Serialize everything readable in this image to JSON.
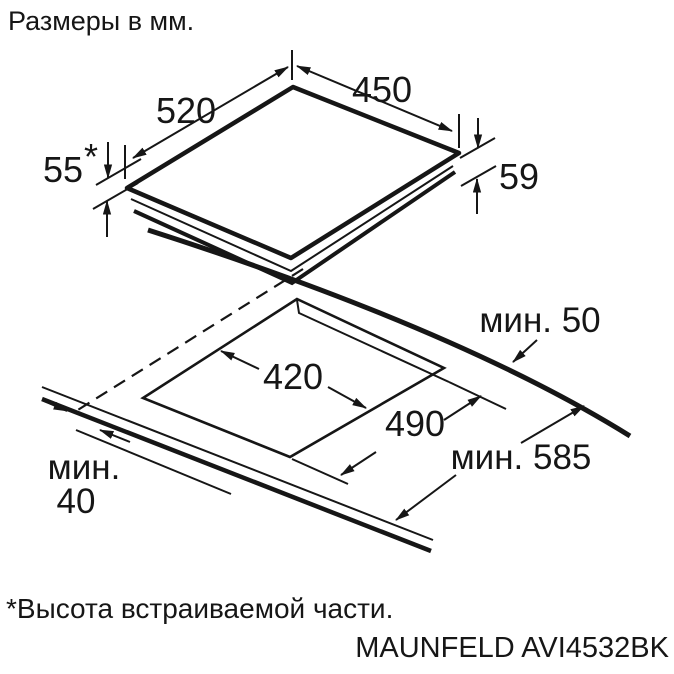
{
  "page": {
    "title": "Размеры в мм.",
    "footnote": "*Высота встраиваемой части.",
    "model": "MAUNFELD AVI4532BK"
  },
  "top_view": {
    "description": "hob perspective view",
    "depth_label": "520",
    "width_label": "450",
    "height_front_label": "55",
    "height_front_star": "*",
    "height_right_label": "59"
  },
  "cutout_view": {
    "description": "worktop cutout perspective view",
    "cutout_width_label": "420",
    "cutout_depth_label": "490",
    "min_rear_label": "мин. 50",
    "min_worktop_depth_label": "мин. 585",
    "min_thickness_label_line1": "мин.",
    "min_thickness_label_line2": "40"
  },
  "colors": {
    "ink": "#161616",
    "background": "#ffffff"
  }
}
